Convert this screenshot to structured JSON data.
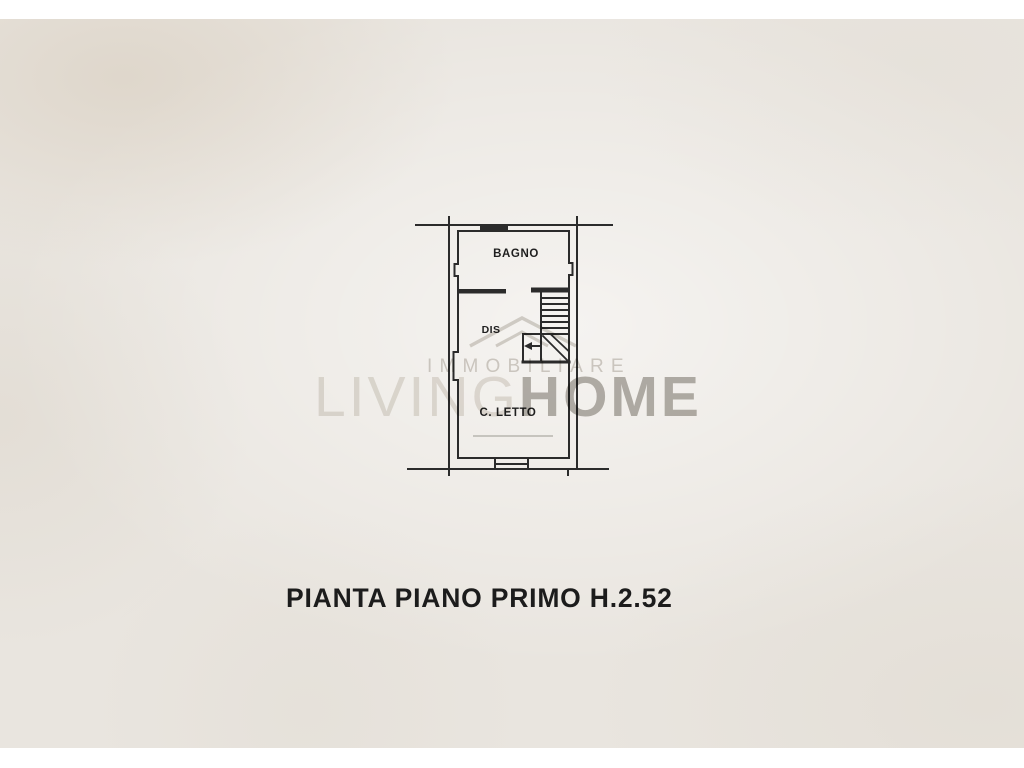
{
  "document": {
    "caption": "PIANTA PIANO PRIMO H.2.52"
  },
  "floor_plan": {
    "line_color": "#2b2b2b",
    "rooms": [
      {
        "name": "bathroom",
        "label": "BAGNO"
      },
      {
        "name": "hallway",
        "label": "DIS"
      },
      {
        "name": "bedroom",
        "label": "C. LETTO"
      }
    ]
  },
  "watermark": {
    "top_line": "IMMOBILIARE",
    "main_light": "LIVING",
    "main_bold": "HOME"
  },
  "colors": {
    "page_background": "#ffffff",
    "paper": "#e9e5df",
    "caption_text": "#1c1c1c",
    "watermark_light": "#e6e3de",
    "watermark_mid": "#d4d1cc",
    "watermark_bold": "#b7b4af"
  }
}
